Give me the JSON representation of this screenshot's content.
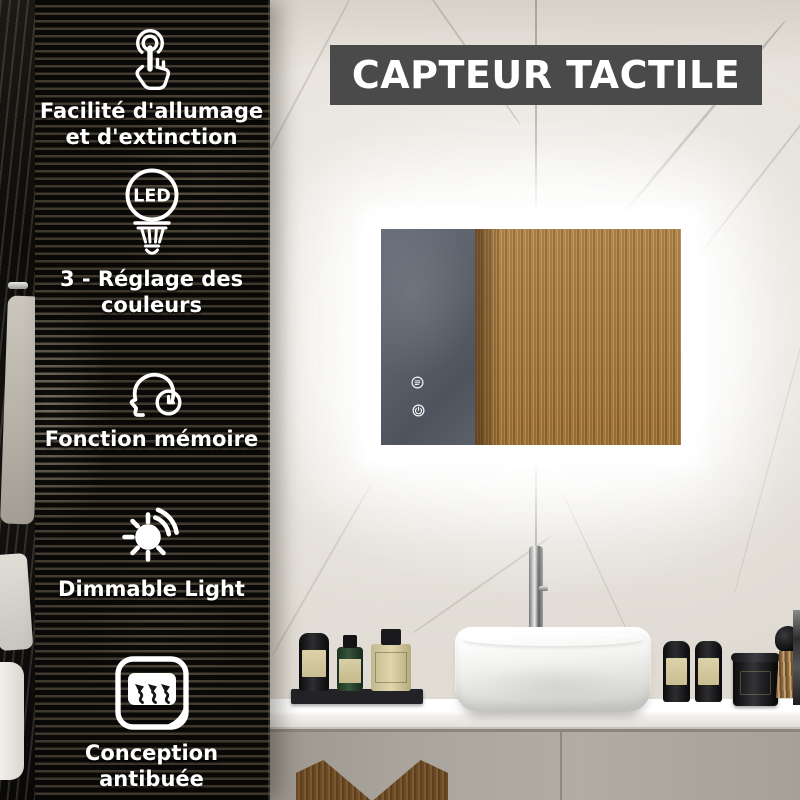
{
  "banner": {
    "label": "CAPTEUR TACTILE"
  },
  "sidebar": {
    "features": [
      {
        "icon": "touch-tap-icon",
        "label": "Facilité d'allumage et d'extinction",
        "lines": [
          "Facilité d'allumage",
          "et d'extinction"
        ]
      },
      {
        "icon": "led-bulb-icon",
        "badge": "LED",
        "label": "3 - Réglage des couleurs",
        "lines": [
          "3 - Réglage des",
          "couleurs"
        ]
      },
      {
        "icon": "memory-head-clock-icon",
        "label": "Fonction mémoire",
        "lines": [
          "Fonction mémoire"
        ]
      },
      {
        "icon": "dimmable-sun-icon",
        "label": "Dimmable Light",
        "lines": [
          "Dimmable Light"
        ]
      },
      {
        "icon": "antifog-icon",
        "label": "Conception antibuée",
        "lines": [
          "Conception",
          "antibuée"
        ]
      }
    ]
  },
  "mirror": {
    "touch_sensors": [
      {
        "icon": "light-settings-sensor-icon"
      },
      {
        "icon": "power-sensor-icon"
      }
    ]
  },
  "colors": {
    "banner_bg": "#4a4a4a",
    "banner_text": "#ffffff",
    "sidebar_text": "#ffffff",
    "led_glow": "#ffffff",
    "mirror_wood": "#b2813f",
    "mirror_slate": "#5c6370",
    "wall_marble": "#e8e4dd",
    "counter": "#f7f6f3",
    "cabinet": "#a6a199"
  }
}
